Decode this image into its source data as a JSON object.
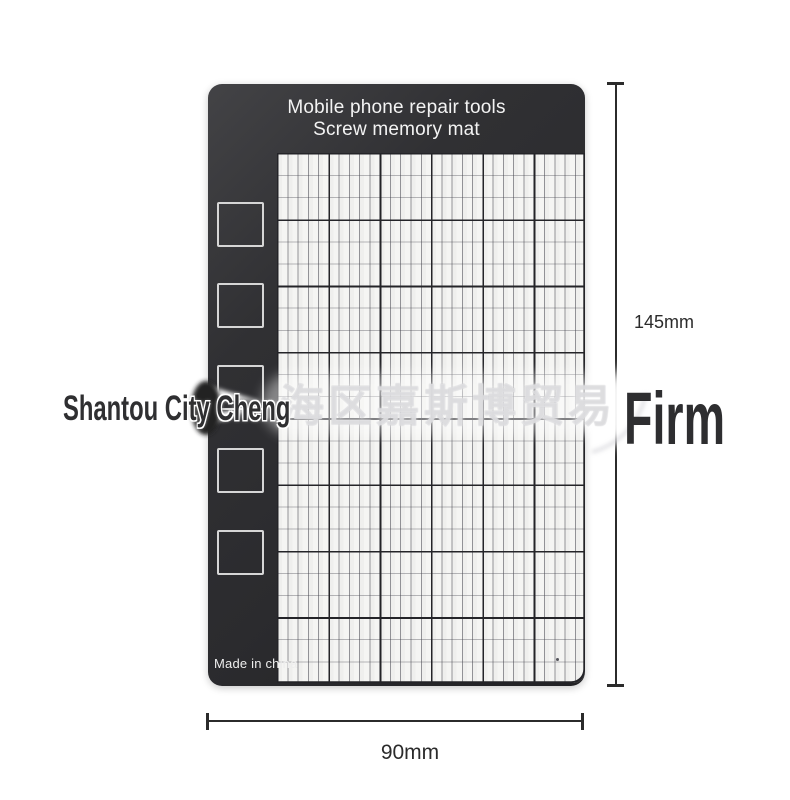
{
  "product": {
    "title_line1": "Mobile phone repair tools",
    "title_line2": "Screw memory mat",
    "origin_label": "Made in china"
  },
  "dimensions": {
    "height": "145mm",
    "width": "90mm"
  },
  "watermark": {
    "prefix": "Shantou City Cheng",
    "cjk": "海区嘉斯博贸易",
    "suffix": "Firm"
  },
  "mat": {
    "slot_count": 5,
    "grid": {
      "major_columns": 6,
      "major_rows": 8,
      "minor_cells_per_major_x": 5,
      "minor_cells_per_major_y": 3
    },
    "colors": {
      "mat_dark": "#2d2d30",
      "grid_background": "#f5f5f3",
      "grid_major_line": "#242428",
      "grid_minor_line": "#7d7d84",
      "slot_border": "#d6d6d6",
      "title_text": "#f3f3f3",
      "dimension_line": "#2b2b2b",
      "watermark_text": "#2f2f31"
    }
  }
}
